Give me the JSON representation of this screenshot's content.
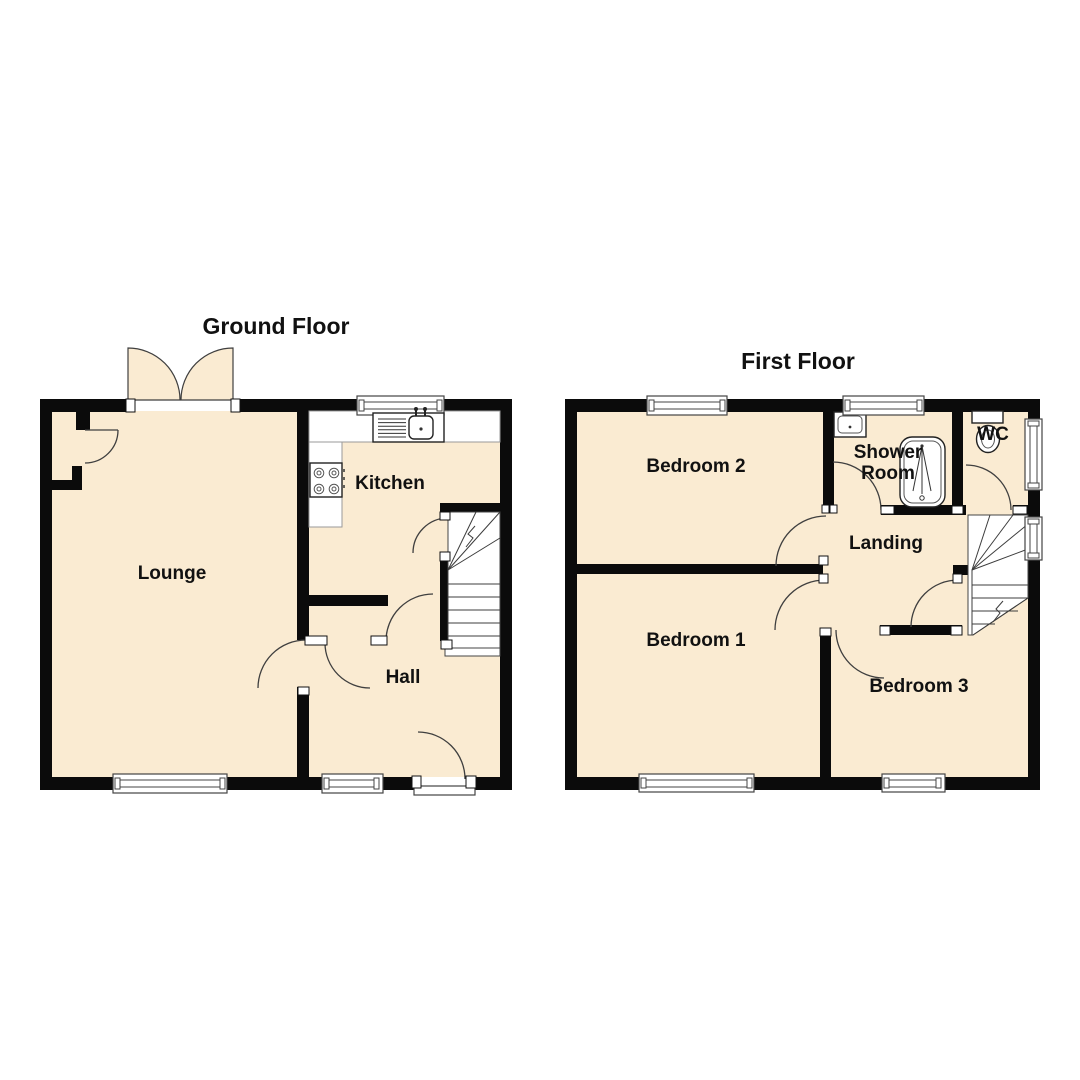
{
  "ground_floor": {
    "title": "Ground Floor",
    "rooms": {
      "lounge": "Lounge",
      "kitchen": "Kitchen",
      "hall": "Hall"
    },
    "fixtures": [
      "kitchen-sink",
      "hob",
      "stairs-up",
      "patio-doors",
      "front-door"
    ]
  },
  "first_floor": {
    "title": "First Floor",
    "rooms": {
      "bedroom2": "Bedroom 2",
      "shower_room_line1": "Shower",
      "shower_room_line2": "Room",
      "wc": "WC",
      "landing": "Landing",
      "bedroom1": "Bedroom 1",
      "bedroom3": "Bedroom 3"
    },
    "fixtures": [
      "basin",
      "shower-bath",
      "toilet",
      "stairs"
    ]
  },
  "colors": {
    "floor": "#FAEBD2",
    "wall": "#0B0B0B",
    "door_arc": "#3F3F3F",
    "window_frame": "#444444",
    "fixture_outline": "#222222",
    "label_text": "#111111"
  }
}
